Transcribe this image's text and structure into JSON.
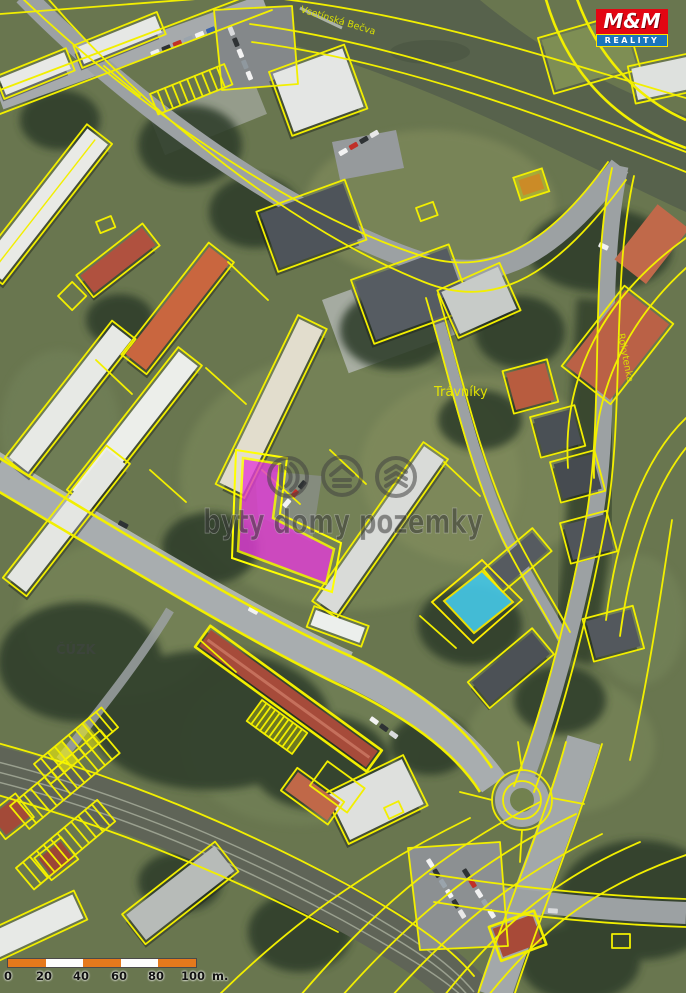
{
  "map": {
    "labels": {
      "river": "Vsetínská Bečva",
      "district": "Trávníky",
      "stream": "Rokytenka",
      "provider": "ČÚZK"
    },
    "watermark": {
      "text": "byty domy pozemky",
      "icons": [
        "door-icon",
        "house-icon",
        "layers-icon"
      ]
    },
    "highlight": {
      "parcel_fill": "#e23cd8",
      "parcel_outline": "#ffff00",
      "secondary_building_fill": "#45c8e8",
      "cadastre_line": "#f2ef00"
    }
  },
  "logo": {
    "name": "M&M Reality",
    "line1": "M&M",
    "line2": "REALITY",
    "top_bg": "#e30613",
    "bottom_bg": "#1b75bc"
  },
  "scalebar": {
    "ticks": [
      "0",
      "20",
      "40",
      "60",
      "80",
      "100"
    ],
    "unit": "m.",
    "colors": [
      "#e5791c",
      "#ffffff"
    ]
  }
}
